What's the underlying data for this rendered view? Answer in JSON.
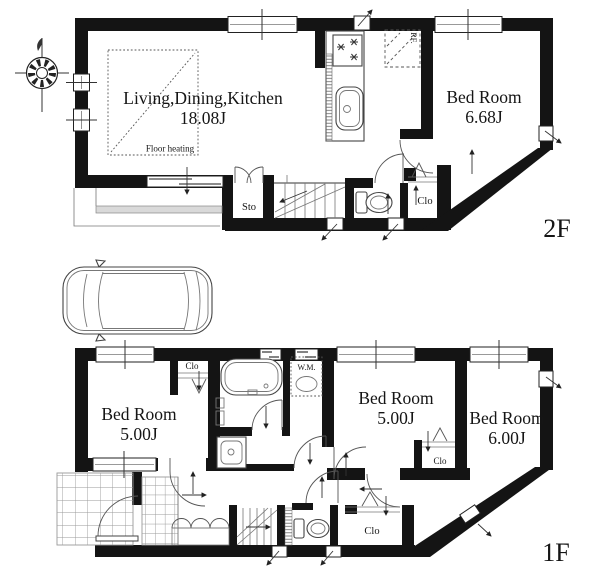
{
  "colors": {
    "wall": "#141414",
    "balcony_rail": "#d9d9d9"
  },
  "floor2": {
    "floor_label": "2F",
    "ldk": {
      "name": "Living,Dining,Kitchen",
      "area": "18.08J",
      "floor_heating_label": "Floor heating"
    },
    "bedroom": {
      "name": "Bed Room",
      "area": "6.68J"
    },
    "storage_label": "Sto",
    "closet_label": "Clo",
    "refrigerator_label": "RF."
  },
  "floor1": {
    "floor_label": "1F",
    "bedroom_left": {
      "name": "Bed Room",
      "area": "5.00J"
    },
    "bedroom_middle": {
      "name": "Bed Room",
      "area": "5.00J"
    },
    "bedroom_right": {
      "name": "Bed Room",
      "area": "6.00J"
    },
    "closet_bed1_label": "Clo",
    "closet_bed2_label": "Clo",
    "closet_hall_label": "Clo",
    "washing_machine_label": "W.M."
  }
}
